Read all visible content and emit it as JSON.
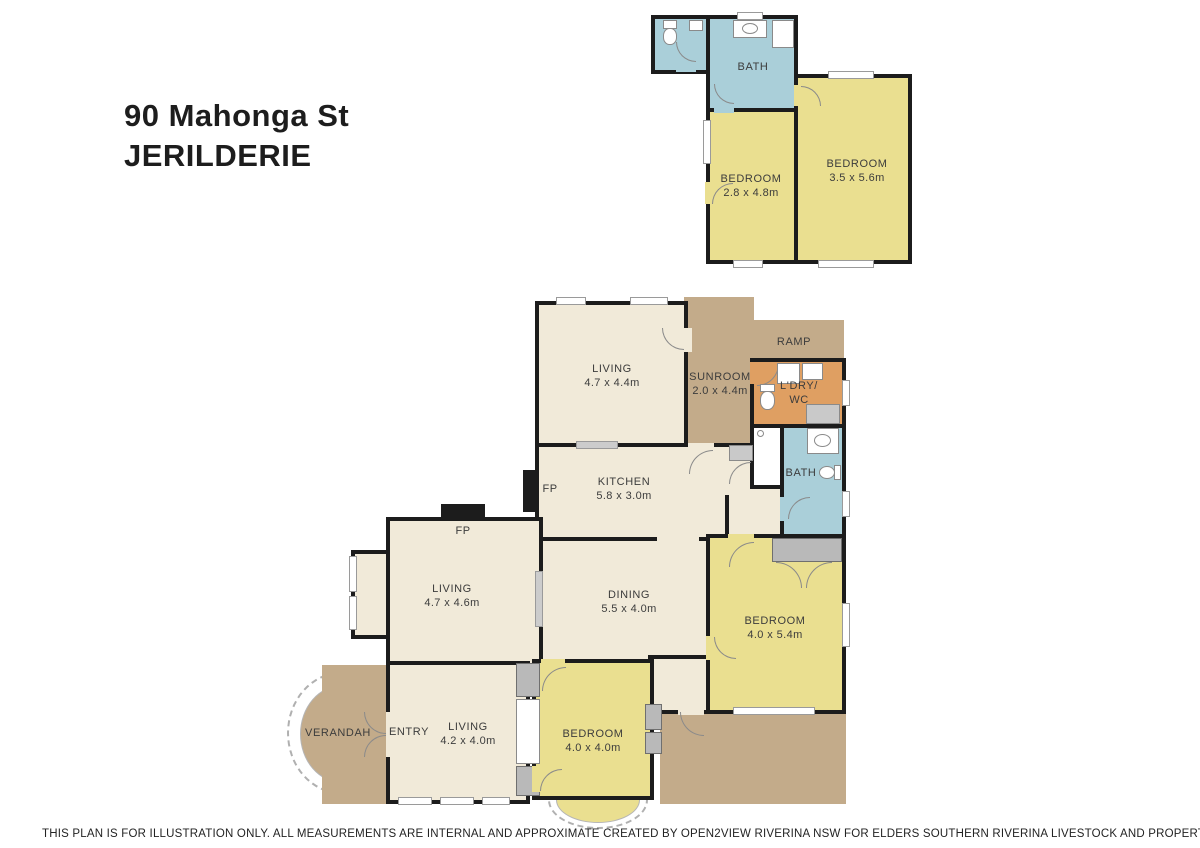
{
  "title": {
    "line1": "90 Mahonga St",
    "line2": "JERILDERIE"
  },
  "footer": {
    "disclaimer": "THIS PLAN IS FOR ILLUSTRATION ONLY.  ALL MEASUREMENTS ARE INTERNAL AND APPROXIMATE CREATED BY OPEN2VIEW RIVERINA NSW FOR ELDERS SOUTHERN RIVERINA LIVESTOCK AND PROPERTY, FINLEY NSW."
  },
  "labels": {
    "unit": {
      "bath": {
        "name": "BATH"
      },
      "bedroom_small": {
        "name": "BEDROOM",
        "dims": "2.8 x 4.8m"
      },
      "bedroom_large": {
        "name": "BEDROOM",
        "dims": "3.5 x 5.6m"
      }
    },
    "house": {
      "living_top": {
        "name": "LIVING",
        "dims": "4.7 x 4.4m"
      },
      "sunroom": {
        "name": "SUNROOM",
        "dims": "2.0 x 4.4m"
      },
      "ramp": {
        "name": "RAMP"
      },
      "laundry": {
        "line1": "L'DRY/",
        "line2": "WC"
      },
      "bath": {
        "name": "BATH"
      },
      "kitchen": {
        "name": "KITCHEN",
        "dims": "5.8 x 3.0m"
      },
      "fp_kitchen": "FP",
      "fp_living": "FP",
      "living_mid": {
        "name": "LIVING",
        "dims": "4.7 x 4.6m"
      },
      "dining": {
        "name": "DINING",
        "dims": "5.5 x 4.0m"
      },
      "bedroom_right": {
        "name": "BEDROOM",
        "dims": "4.0 x 5.4m"
      },
      "verandah": {
        "name": "VERANDAH"
      },
      "entry": {
        "name": "ENTRY"
      },
      "living_front": {
        "name": "LIVING",
        "dims": "4.2 x 4.0m"
      },
      "bedroom_front": {
        "name": "BEDROOM",
        "dims": "4.0 x 4.0m"
      }
    }
  },
  "colors": {
    "wall": "#1c1c1c",
    "room_cream": "#f1ead9",
    "room_yellow": "#eadf90",
    "room_blue": "#aacfd9",
    "outdoor_tan": "#c3ab8a",
    "laundry_orange": "#df9f62",
    "robe_grey": "#b9b9b9",
    "text": "#3c3c3c"
  }
}
